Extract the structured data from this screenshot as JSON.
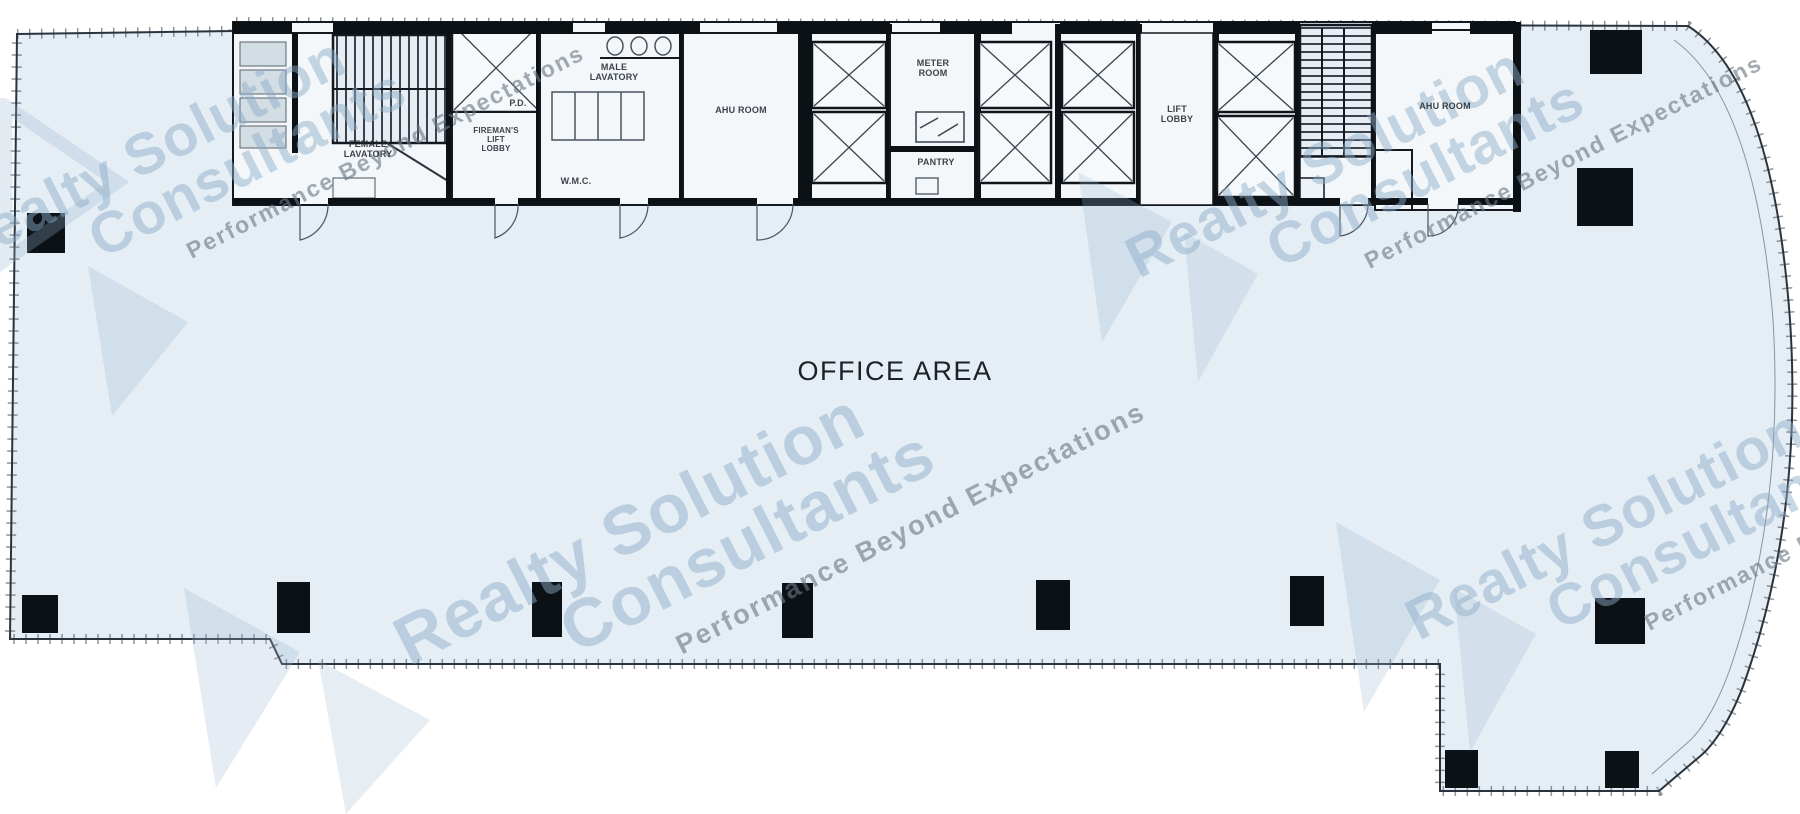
{
  "watermark": {
    "brand_line1": "Realty Solution",
    "brand_line2": "Consultants",
    "tagline": "Performance Beyond Expectations",
    "brand_color": "#8cacc7",
    "tagline_color": "#6a7885"
  },
  "plan": {
    "office_area_label": "OFFICE AREA",
    "rooms": {
      "female_lavatory": "FEMALE\nLAVATORY",
      "pd": "P.D.",
      "firemans_lift_lobby": "FIREMAN'S\nLIFT\nLOBBY",
      "male_lavatory": "MALE\nLAVATORY",
      "wmc": "W.M.C.",
      "ahu_room_left": "AHU ROOM",
      "meter_room": "METER\nROOM",
      "pantry": "PANTRY",
      "lift_lobby": "LIFT\nLOBBY",
      "ahu_room_right": "AHU ROOM"
    },
    "colors": {
      "floor": "#e5eef5",
      "service_room": "#f3f7fa",
      "wall": "#10151a",
      "column": "#0c1116"
    }
  }
}
